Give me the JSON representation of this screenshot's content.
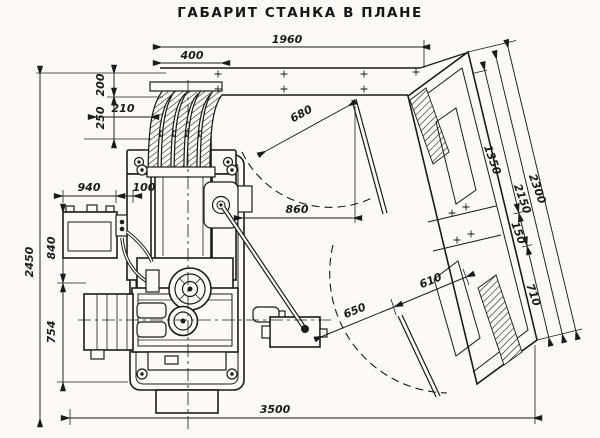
{
  "title": "ГАБАРИТ СТАНКА В ПЛАНЕ",
  "dims": {
    "d1960": "1960",
    "d400": "400",
    "d200": "200",
    "d250": "250",
    "d210": "210",
    "d940": "940",
    "d100": "100",
    "d2450": "2450",
    "d840": "840",
    "d754": "754",
    "d3500": "3500",
    "d860": "860",
    "d680": "680",
    "d1350": "1350",
    "d2150": "2150",
    "d2300": "2300",
    "d150": "150",
    "d710": "710",
    "d650": "650",
    "d610": "610"
  }
}
